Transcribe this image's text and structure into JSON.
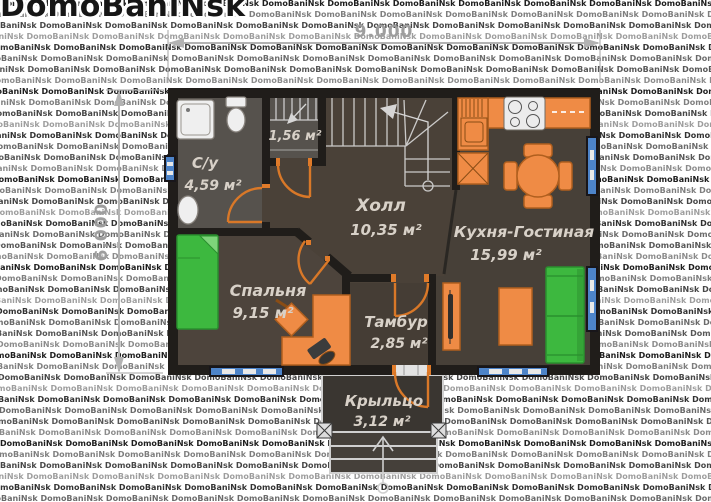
{
  "watermark": {
    "brand": "DomoBaniNsk",
    "tile_text": "DomoBaniNsk"
  },
  "dimensions": {
    "width_label": "9.000",
    "height_label": "6.000"
  },
  "rooms": [
    {
      "id": "su",
      "name": "С/у",
      "area": "4,59 м²"
    },
    {
      "id": "closet",
      "name": "",
      "area": "1,56 м²"
    },
    {
      "id": "hall",
      "name": "Холл",
      "area": "10,35 м²"
    },
    {
      "id": "kitchen",
      "name": "Кухня-Гостиная",
      "area": "15,99 м²"
    },
    {
      "id": "bedroom",
      "name": "Спальня",
      "area": "9,15 м²"
    },
    {
      "id": "tambour",
      "name": "Тамбур",
      "area": "2,85 м²"
    },
    {
      "id": "porch",
      "name": "Крыльцо",
      "area": "3,12 м²"
    }
  ],
  "colors": {
    "wall": "#201d1a",
    "floor_hall": "#4a4138",
    "floor_wet": "#56524d",
    "floor_bedroom": "#4d443c",
    "floor_kitchen": "#474038",
    "floor_tambour": "#453d35",
    "floor_porch": "#3a3631",
    "furniture_orange": "#ef8b45",
    "furniture_green": "#3db83f",
    "door_orange": "#d97828",
    "window_blue": "#4d84c9",
    "label_text": "#d8d1c8",
    "dimension_gray": "#a8a8a8"
  }
}
